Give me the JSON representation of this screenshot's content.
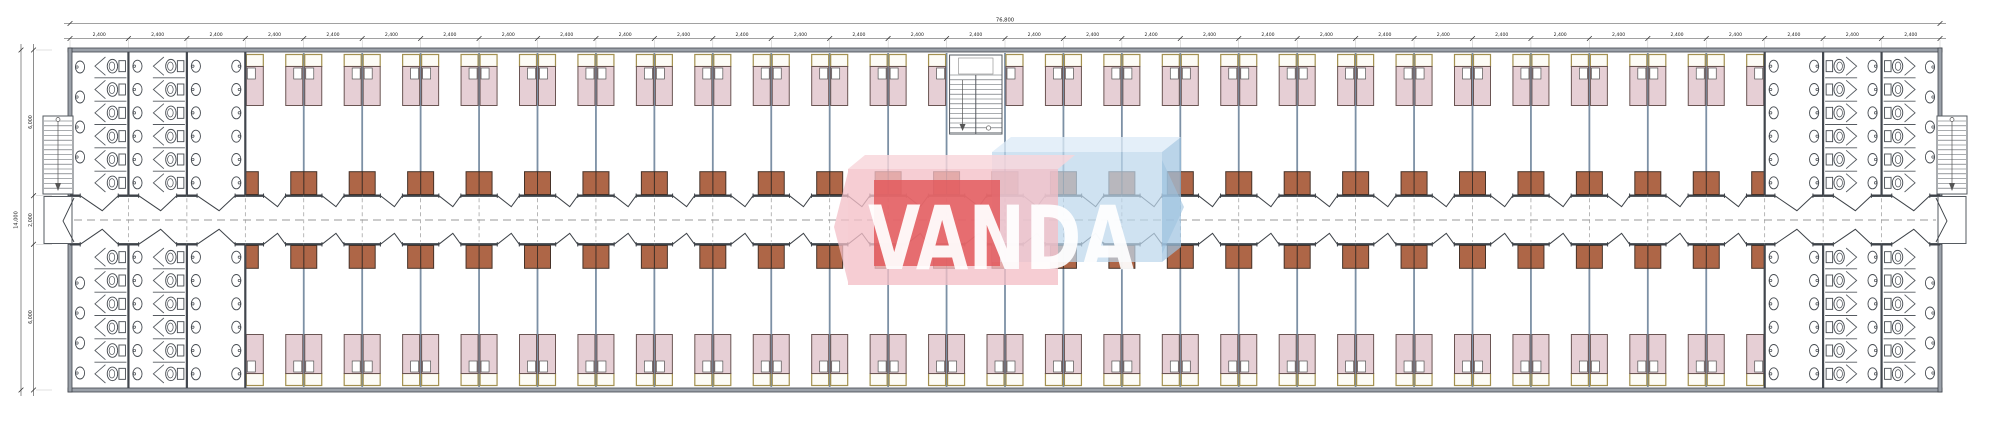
{
  "drawing": {
    "title_watermark": "VANDA",
    "dimensions": {
      "top_total": "76,800",
      "top_bay": "2,400",
      "top_bay_count": 32,
      "left_total": "14,000",
      "left_segments": [
        "6,000",
        "2,000",
        "6,000"
      ]
    },
    "layout": {
      "bays_total": 32,
      "bathroom_bays_per_end": 3,
      "bedroom_bays": 26,
      "stair_bay_index": 12,
      "toilet_stalls_per_column": 6,
      "wash_basins_per_column": 6,
      "outer_wall_basins": 4
    },
    "colors": {
      "wall": "#41464d",
      "wall_fill": "#9ba1a9",
      "corridor_wall": "#3d4248",
      "partition": "#7c90a5",
      "bed_fill": "#e6cfd5",
      "bed_border": "#6a5553",
      "headboard_fill": "#fdfcf6",
      "headboard_border": "#a3904f",
      "pillow_fill": "#ffffff",
      "wardrobe_fill": "#ae6647",
      "wardrobe_border": "#463228",
      "fixture_stroke": "#474c52",
      "stall_line": "#565b61",
      "dash_center": "#777777",
      "dash_grid": "#999999",
      "dim_line": "#444444",
      "dim_text": "#222222",
      "ext_line": "#bbbbbb",
      "watermark_pink": "#f3bfc7",
      "watermark_pink_light": "#f8d6da",
      "watermark_red": "#e25558",
      "watermark_blue": "#bdd7eb",
      "watermark_blue_light": "#dcebf7",
      "watermark_blue_side": "#9fc3e0",
      "watermark_text": "#ffffff"
    }
  }
}
